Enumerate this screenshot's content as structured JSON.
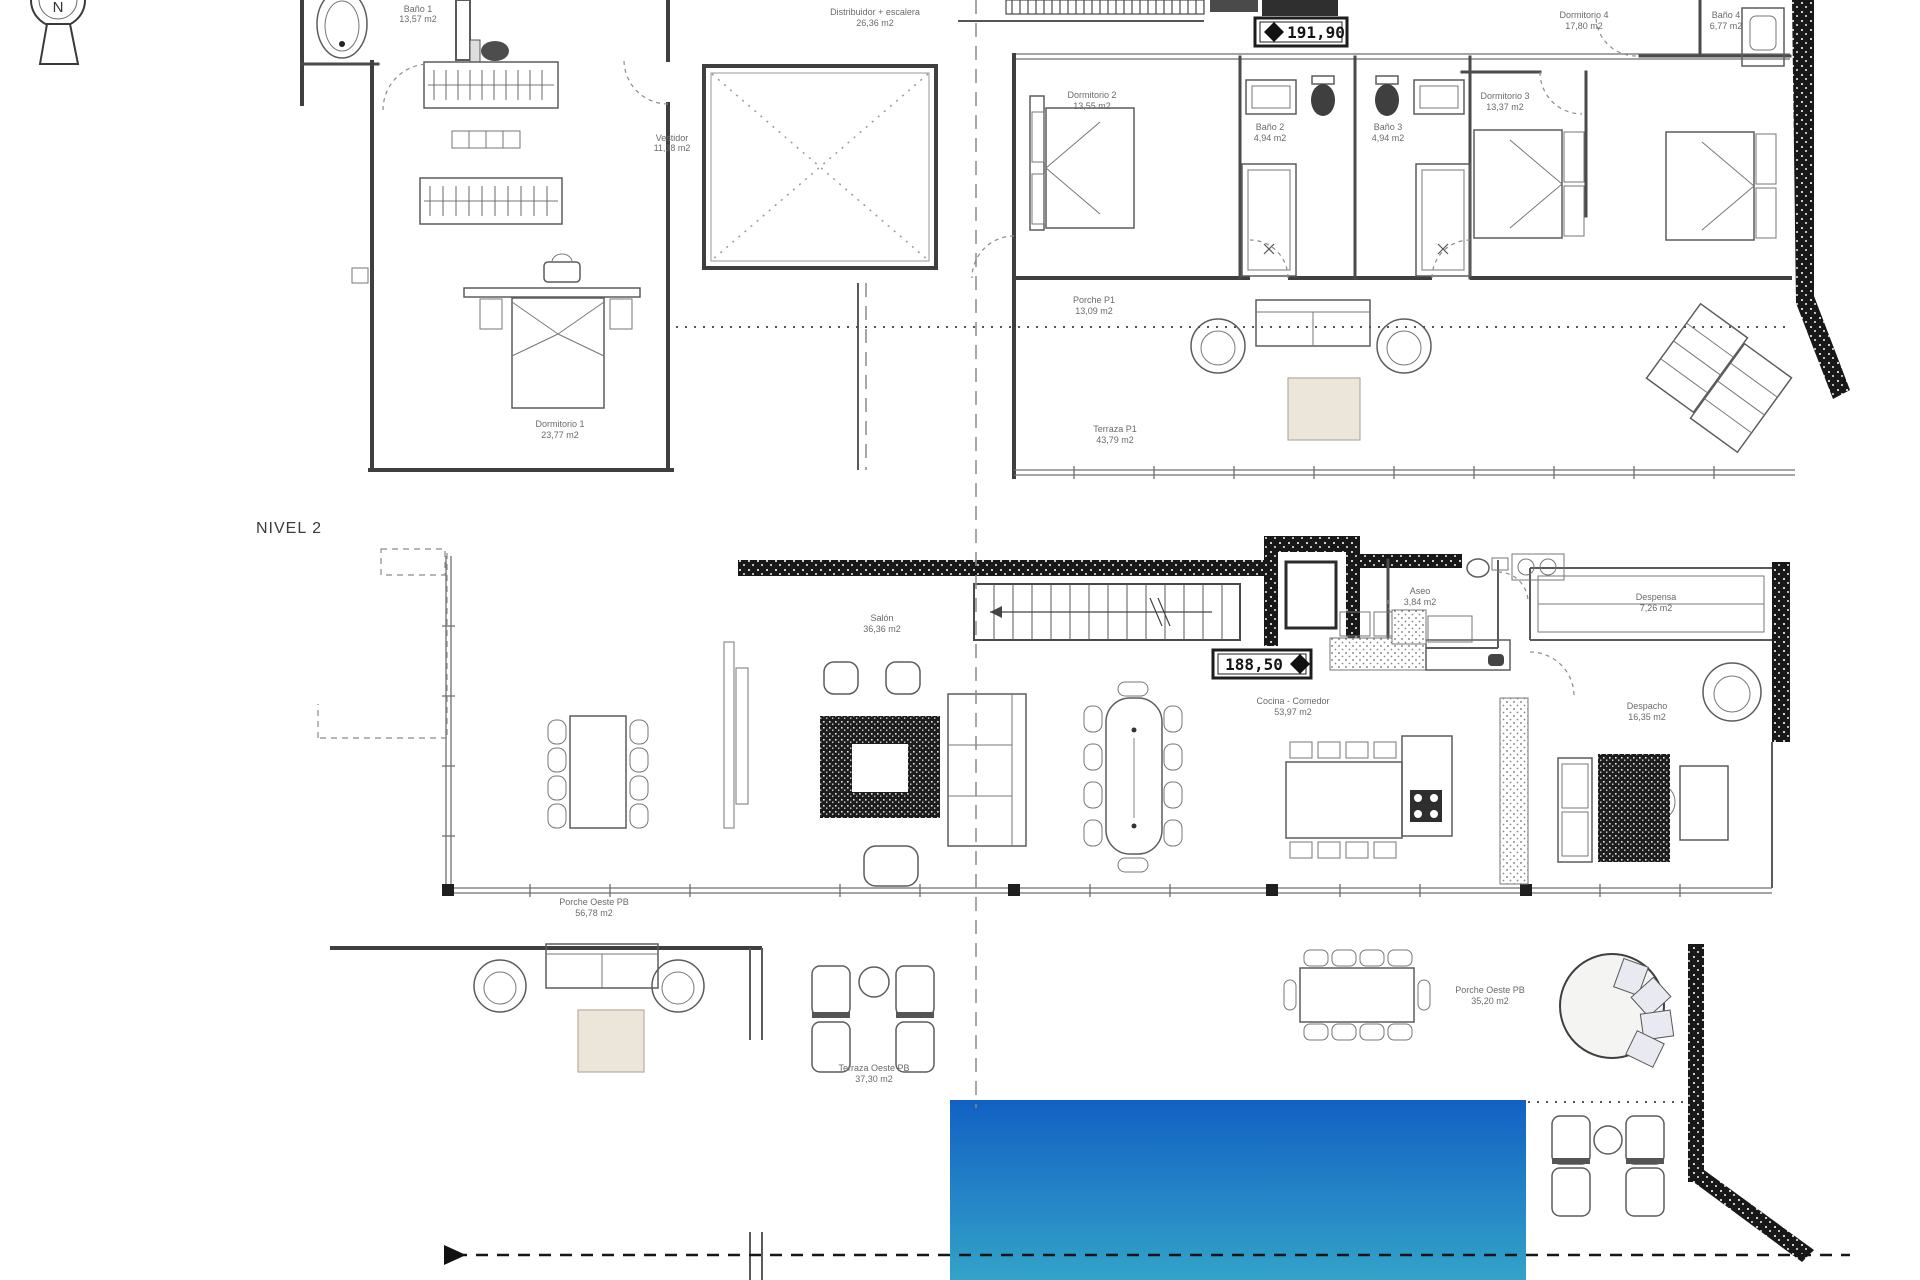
{
  "document": {
    "type": "architectural floor plan"
  },
  "north": {
    "letter": "N"
  },
  "levels": {
    "level2_title": "NIVEL 2",
    "upper_marker": "191,90",
    "lower_marker": "188,50"
  },
  "upper_rooms": [
    {
      "name": "Baño 1",
      "area": "13,57 m2"
    },
    {
      "name": "Vestidor",
      "area": "11,38 m2"
    },
    {
      "name": "Distribuidor + escalera",
      "area": "26,36 m2"
    },
    {
      "name": "Dormitorio 1",
      "area": "23,77 m2"
    },
    {
      "name": "Dormitorio 2",
      "area": "13,55 m2"
    },
    {
      "name": "Baño 2",
      "area": "4,94 m2"
    },
    {
      "name": "Baño 3",
      "area": "4,94 m2"
    },
    {
      "name": "Dormitorio 3",
      "area": "13,37 m2"
    },
    {
      "name": "Dormitorio 4",
      "area": "17,80 m2"
    },
    {
      "name": "Baño 4",
      "area": "6,77 m2"
    },
    {
      "name": "Porche P1",
      "area": "13,09 m2"
    },
    {
      "name": "Terraza P1",
      "area": "43,79 m2"
    }
  ],
  "lower_rooms": [
    {
      "name": "Salón",
      "area": "36,36 m2"
    },
    {
      "name": "Cocina - Comedor",
      "area": "53,97 m2"
    },
    {
      "name": "Aseo",
      "area": "3,84 m2"
    },
    {
      "name": "Despensa",
      "area": "7,26 m2"
    },
    {
      "name": "Despacho",
      "area": "16,35 m2"
    },
    {
      "name": "Porche Oeste PB",
      "area": "56,78 m2"
    },
    {
      "name": "Terraza Oeste PB",
      "area": "37,30 m2"
    },
    {
      "name": "Porche Oeste PB",
      "area": "35,20 m2"
    }
  ],
  "colors": {
    "pool_top": "#1261c3",
    "pool_bottom": "#33a3c8",
    "rug_tan": "#ece5da",
    "wall_dark": "#161616"
  }
}
